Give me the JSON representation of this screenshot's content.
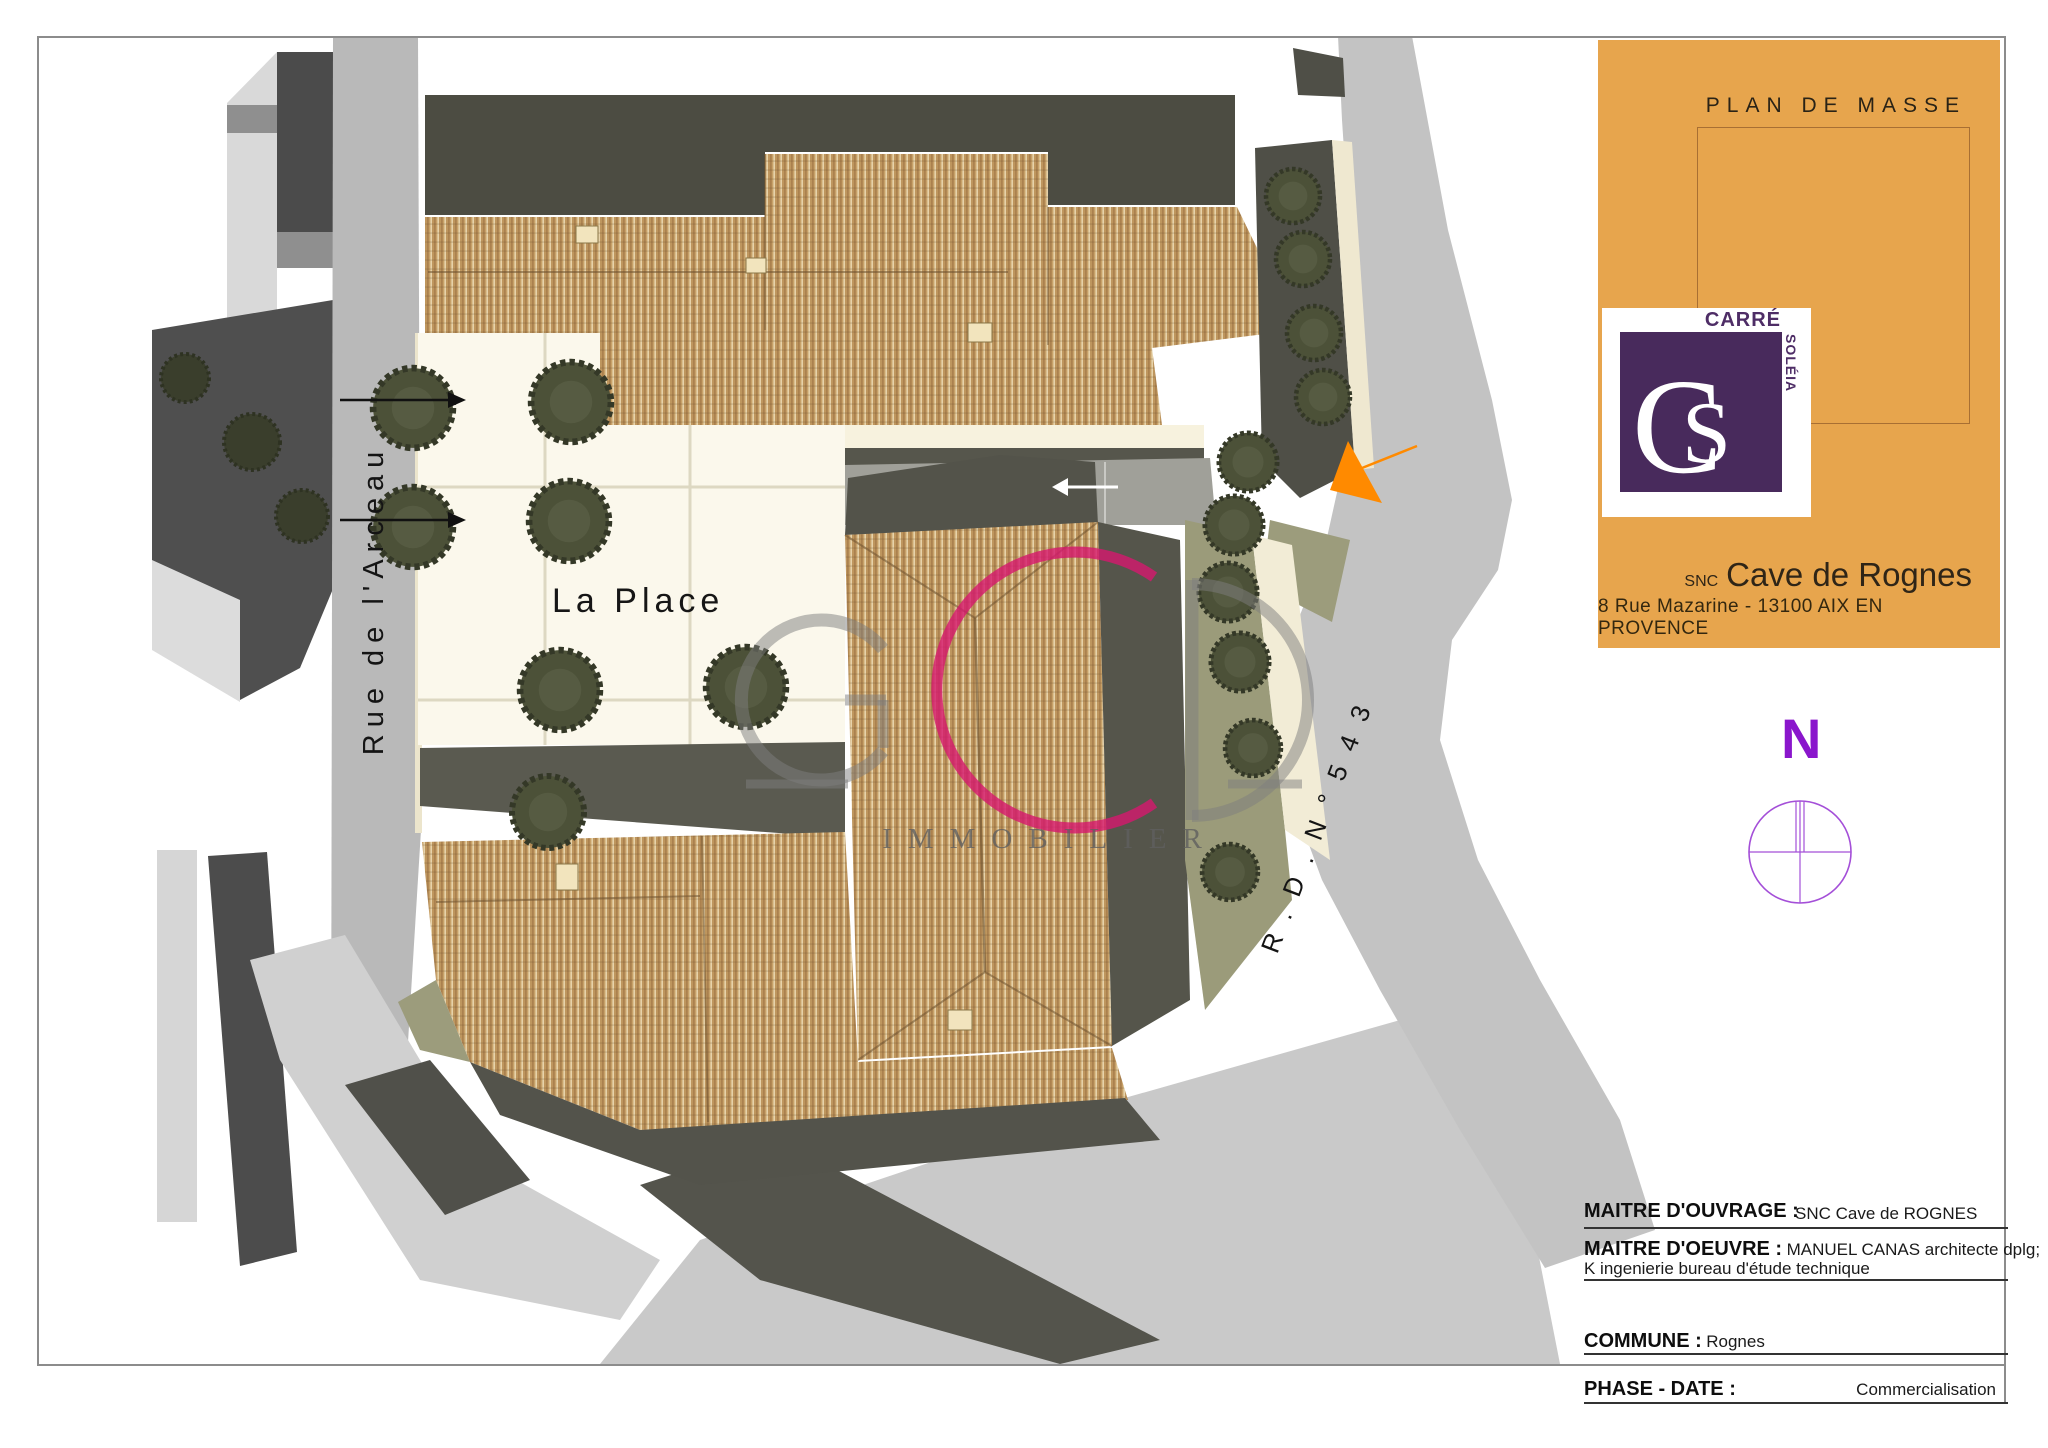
{
  "sheet": {
    "plan_title": "PLAN DE MASSE",
    "logo": {
      "brand_top": "CARRÉ",
      "brand_side": "SOLÉIA",
      "monogram_c": "C",
      "monogram_s": "S"
    },
    "client": {
      "prefix": "SNC",
      "name": "Cave de Rognes",
      "address": "8 Rue Mazarine - 13100 AIX EN PROVENCE"
    },
    "north_label": "N"
  },
  "map": {
    "labels": {
      "plaza": "La Place",
      "street_left": "Rue de l'Arceau",
      "road_right": "R . D . N °  5 4 3"
    },
    "watermark": {
      "letters": "GCD",
      "text": "IMMOBILIER"
    }
  },
  "title_block": {
    "rows": [
      {
        "label": "MAITRE D'OUVRAGE :",
        "value": "SNC Cave de ROGNES"
      },
      {
        "label": "MAITRE D'OEUVRE :",
        "value": "MANUEL CANAS architecte dplg;",
        "value2": "K ingenierie bureau d'étude technique"
      },
      {
        "label": "COMMUNE :",
        "value": "Rognes"
      },
      {
        "label": "PHASE - DATE :",
        "value": "Commercialisation"
      }
    ]
  },
  "colors": {
    "panel_orange": "#E7A54D",
    "logo_purple": "#482A5C",
    "north_purple": "#8A16CC",
    "watermark_magenta": "#D6186E",
    "marker_orange": "#FF8A00"
  }
}
